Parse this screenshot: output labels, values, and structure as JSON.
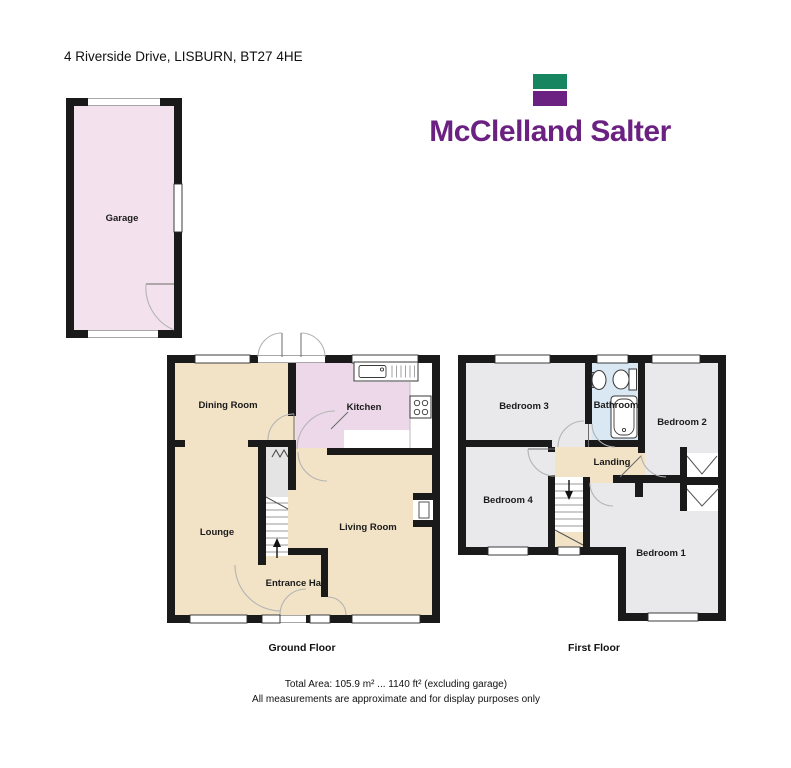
{
  "address": "4 Riverside Drive, LISBURN, BT27 4HE",
  "logo": {
    "name": "McClelland Salter"
  },
  "rooms": {
    "garage": "Garage",
    "dining": "Dining Room",
    "kitchen": "Kitchen",
    "lounge": "Lounge",
    "living": "Living Room",
    "hall": "Entrance Hall",
    "bed3": "Bedroom 3",
    "bathroom": "Bathroom",
    "bed2": "Bedroom 2",
    "bed4": "Bedroom 4",
    "landing": "Landing",
    "bed1": "Bedroom 1"
  },
  "floors": {
    "ground": "Ground Floor",
    "first": "First Floor"
  },
  "footer": {
    "total_area": "Total Area: 105.9 m² ... 1140 ft² (excluding garage)",
    "disclaimer": "All measurements are approximate and for display purposes only"
  },
  "colors": {
    "wall": "#1a1a1a",
    "tan": "#f2e3c7",
    "garagePink": "#f3e2ee",
    "kitchenPink": "#ecd8e8",
    "roomGray": "#e9e9eb",
    "bathBlue": "#d9e8f2",
    "stairGray": "#e4e4e4",
    "logoGreen": "#17855f",
    "logoPurple": "#6b2181"
  }
}
